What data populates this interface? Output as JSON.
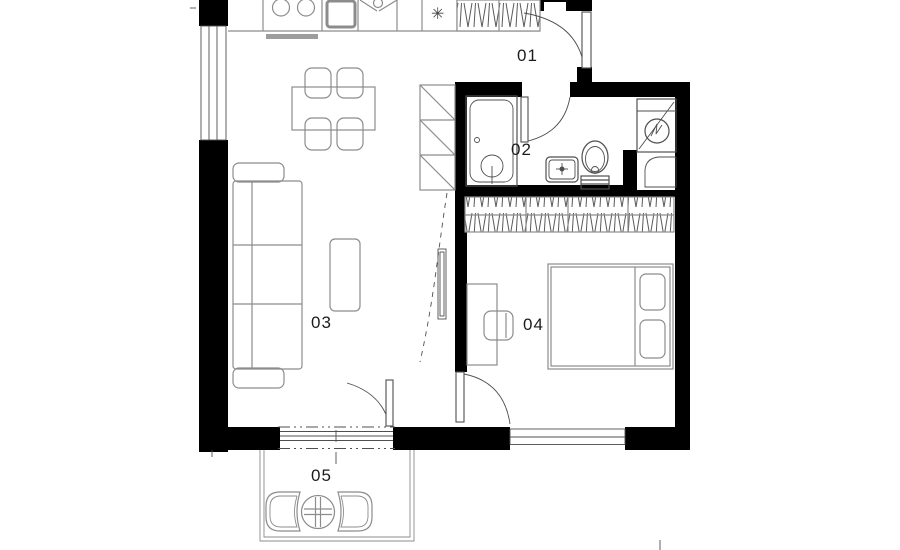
{
  "colors": {
    "bg": "#ffffff",
    "wall": "#000000",
    "line": "#8c8c8c",
    "line_dark": "#4f4f4f",
    "fill_gray": "#9c9c9c",
    "label": "#1c1c1c"
  },
  "rooms": {
    "entry": {
      "number": "01"
    },
    "bathroom": {
      "number": "02"
    },
    "living": {
      "number": "03"
    },
    "bedroom": {
      "number": "04"
    },
    "balcony": {
      "number": "05"
    }
  },
  "icons": {
    "fridge_glyph": "✳"
  }
}
